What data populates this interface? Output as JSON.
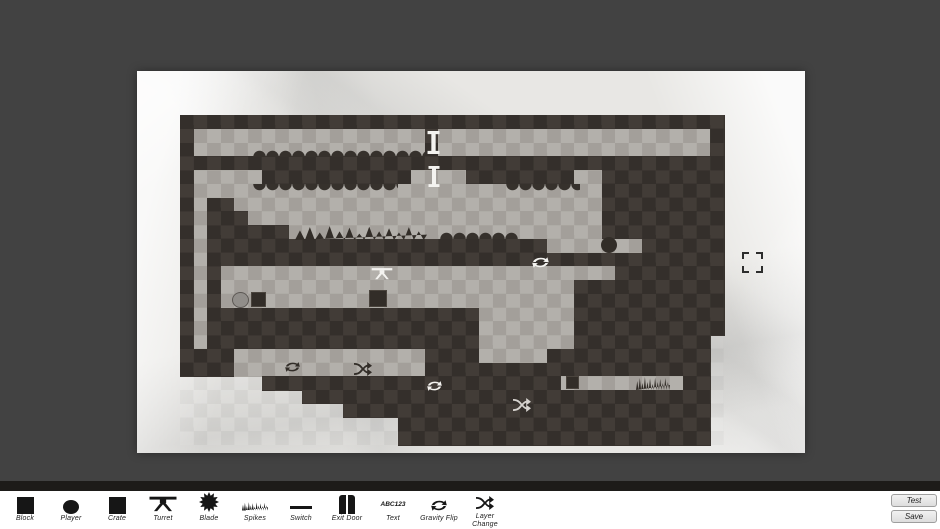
{
  "colors": {
    "window_background": "#424242",
    "paper": "#e8e7e4",
    "tile_dark": "#36312c",
    "tile_light": "#a8a49f",
    "object_dark": "#322d28",
    "object_light": "#f4f3f0",
    "object_gray": "#918e8a",
    "toolbar_background": "#ffffff",
    "toolbar_divider": "#1d1b19",
    "icon_color": "#161616"
  },
  "level": {
    "grid_cols": 40,
    "grid_rows": 24,
    "legend": {
      "#": "solid-block",
      ".": "open-interior",
      " ": "empty"
    },
    "grid": [
      "########################################",
      "#.................#....................#",
      "#.................#....................#",
      "########################################",
      "#.....###########....########..#########",
      "#..............................#########",
      "#.##...........................#########",
      "#.###..........................#########",
      "#.######.......................#########",
      "#.#########################.......######",
      "#.######################################",
      "#.#.............................########",
      "#.#..........................###########",
      "#.#..........................###########",
      "#.####################.......###########",
      "#.####################.......###########",
      "#.####################.......########## ",
      "####..............####.....############ ",
      "####..............##################### ",
      "      ######################.........## ",
      "         ############################## ",
      "            ########################### ",
      "                ####################### ",
      "                ####################### "
    ],
    "objects": [
      {
        "type": "scallops",
        "dir": "up",
        "x": 253,
        "y": 149,
        "w": 172,
        "h": 8
      },
      {
        "type": "scallops",
        "dir": "down",
        "x": 253,
        "y": 184,
        "w": 145,
        "h": 8
      },
      {
        "type": "scallops",
        "dir": "down",
        "x": 506,
        "y": 184,
        "w": 74,
        "h": 8
      },
      {
        "type": "scallops",
        "dir": "up",
        "x": 440,
        "y": 231,
        "w": 78,
        "h": 8
      },
      {
        "type": "spikes",
        "variant": "dark",
        "x": 295,
        "y": 225,
        "w": 132,
        "h": 15
      },
      {
        "type": "spikes",
        "variant": "dark",
        "x": 636,
        "y": 376,
        "w": 34,
        "h": 14
      },
      {
        "type": "exit-door",
        "variant": "light",
        "x": 427,
        "y": 131,
        "w": 13,
        "h": 23
      },
      {
        "type": "exit-door",
        "variant": "light",
        "x": 428,
        "y": 166,
        "w": 12,
        "h": 21
      },
      {
        "type": "turret",
        "variant": "light",
        "x": 371,
        "y": 266,
        "w": 22,
        "h": 14
      },
      {
        "type": "gravity-flip",
        "variant": "light",
        "x": 532,
        "y": 256,
        "w": 17,
        "h": 13
      },
      {
        "type": "blade-ball",
        "variant": "dark",
        "x": 601,
        "y": 237,
        "w": 16,
        "h": 16
      },
      {
        "type": "player-ball",
        "variant": "gray",
        "x": 232,
        "y": 292,
        "w": 17,
        "h": 16
      },
      {
        "type": "crate",
        "variant": "dark",
        "x": 251,
        "y": 292,
        "w": 15,
        "h": 15
      },
      {
        "type": "crate",
        "variant": "dark",
        "x": 369,
        "y": 290,
        "w": 18,
        "h": 17
      },
      {
        "type": "crate",
        "variant": "dark",
        "x": 566,
        "y": 376,
        "w": 13,
        "h": 13
      },
      {
        "type": "gravity-flip",
        "variant": "dark",
        "x": 285,
        "y": 361,
        "w": 15,
        "h": 12
      },
      {
        "type": "layer-change",
        "variant": "dark",
        "x": 354,
        "y": 362,
        "w": 18,
        "h": 14
      },
      {
        "type": "gravity-flip",
        "variant": "light",
        "x": 427,
        "y": 380,
        "w": 15,
        "h": 12
      },
      {
        "type": "layer-change",
        "variant": "lightgray",
        "x": 513,
        "y": 398,
        "w": 18,
        "h": 14
      },
      {
        "type": "selection-bracket",
        "x": 742,
        "y": 252,
        "w": 21,
        "h": 21
      }
    ]
  },
  "toolbar": {
    "items": [
      {
        "id": "block",
        "label": "Block"
      },
      {
        "id": "player",
        "label": "Player"
      },
      {
        "id": "crate",
        "label": "Crate"
      },
      {
        "id": "turret",
        "label": "Turret"
      },
      {
        "id": "blade",
        "label": "Blade"
      },
      {
        "id": "spikes",
        "label": "Spikes"
      },
      {
        "id": "switch",
        "label": "Switch"
      },
      {
        "id": "exit-door",
        "label": "Exit Door"
      },
      {
        "id": "text",
        "label": "Text",
        "icon_text": "ABC123"
      },
      {
        "id": "gravity-flip",
        "label": "Gravity Flip"
      },
      {
        "id": "layer-change",
        "label": "Layer Change"
      }
    ],
    "buttons": [
      {
        "id": "test",
        "label": "Test"
      },
      {
        "id": "save",
        "label": "Save"
      }
    ]
  }
}
